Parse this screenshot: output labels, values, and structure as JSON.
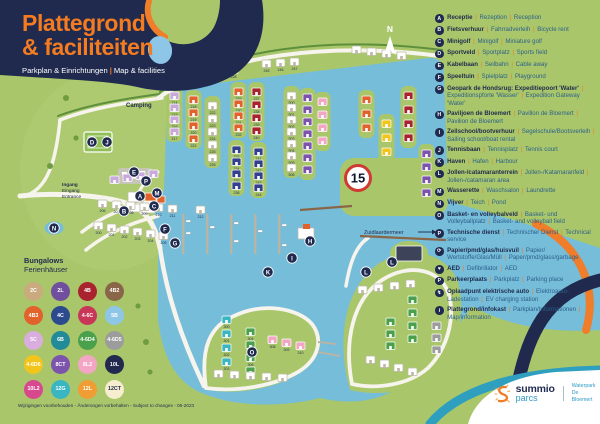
{
  "header": {
    "title_line1": "Plattegrond",
    "title_line2": "& faciliteiten",
    "subtitle_de": "Parkplan & Einrichtungen",
    "subtitle_en": "Map & facilities",
    "separator": "|"
  },
  "colors": {
    "brand_orange": "#f47b20",
    "brand_navy": "#1f2a4e",
    "water": "#76bdd9",
    "land_green": "#a9c76a",
    "sign_red": "#cf3a32"
  },
  "legend": {
    "separator": "|",
    "items": [
      {
        "badge": "A",
        "nl": "Receptie",
        "de": "Rezeption",
        "en": "Reception"
      },
      {
        "badge": "B",
        "nl": "Fietsverhuur",
        "de": "Fahrradverleih",
        "en": "Bicycle rent"
      },
      {
        "badge": "C",
        "nl": "Minigolf",
        "de": "Minigolf",
        "en": "Miniature golf"
      },
      {
        "badge": "D",
        "nl": "Sportveld",
        "de": "Sportplatz",
        "en": "Sports field"
      },
      {
        "badge": "E",
        "nl": "Kabelbaan",
        "de": "Seilbahn",
        "en": "Cable away"
      },
      {
        "badge": "F",
        "nl": "Speeltuin",
        "de": "Spielplatz",
        "en": "Playground"
      },
      {
        "badge": "G",
        "nl": "Geopark de Hondsrug: Expeditiepoort 'Water'",
        "de": "Expeditionspforte 'Wasser'",
        "en": "Expedition Gateway 'Water'"
      },
      {
        "badge": "H",
        "nl": "Paviljoen de Bloemert",
        "de": "Pavillon de Bloemert",
        "en": "Pavilion de Bloemert"
      },
      {
        "badge": "I",
        "nl": "Zeilschool/bootverhuur",
        "de": "Segelschule/Bootsverleih",
        "en": "Sailing school/boat rental"
      },
      {
        "badge": "J",
        "nl": "Tennisbaan",
        "de": "Tennisplatz",
        "en": "Tennis court"
      },
      {
        "badge": "K",
        "nl": "Haven",
        "de": "Hafen",
        "en": "Harbour"
      },
      {
        "badge": "L",
        "nl": "Jollen-/catamaranterrein",
        "de": "Jollen-/Katamaranfeld",
        "en": "Jollen-/catamaran area"
      },
      {
        "badge": "M",
        "nl": "Wasserette",
        "de": "Waschsalon",
        "en": "Laundrette"
      },
      {
        "badge": "N",
        "nl": "Vijver",
        "de": "Teich",
        "en": "Pond"
      },
      {
        "badge": "O",
        "nl": "Basket- en volleybalveld",
        "de": "Basket- und Volleyballplatz",
        "en": "Basket- and volleyball field"
      },
      {
        "badge": "P",
        "nl": "Technische dienst",
        "de": "Technischer Dienst",
        "en": "Technical service"
      },
      {
        "badge": "⟳",
        "icon": "recycle-icon",
        "nl": "Papier/pmd/glas/huisvuil",
        "de": "Papier/ Wertstoffe/Glas/Müll",
        "en": "Paper/pmd/glass/garbage"
      },
      {
        "badge": "♥",
        "icon": "aed-icon",
        "nl": "AED",
        "de": "Defibrillator",
        "en": "AED"
      },
      {
        "badge": "P",
        "icon": "parking-icon",
        "nl": "Parkeerplaats",
        "de": "Parkplatz",
        "en": "Parking place"
      },
      {
        "badge": "↯",
        "icon": "ev-charger-icon",
        "nl": "Oplaadpunt elektrische auto",
        "de": "Elektroauto-Ladestation",
        "en": "EV charging station"
      },
      {
        "badge": "i",
        "icon": "info-icon",
        "nl": "Plattegrond/infokast",
        "de": "Parkplan/Informationen",
        "en": "Map/information"
      }
    ]
  },
  "bungalows": {
    "title_nl": "Bungalows",
    "title_de": "Ferienhäuser",
    "types": [
      {
        "code": "2C",
        "color": "#c9ab7f"
      },
      {
        "code": "2L",
        "color": "#6f4f9e"
      },
      {
        "code": "4B",
        "color": "#a8232e"
      },
      {
        "code": "4B2",
        "color": "#8a6648"
      },
      {
        "code": "4B3",
        "color": "#e2622b"
      },
      {
        "code": "4C",
        "color": "#2c4a8e"
      },
      {
        "code": "4-6C",
        "color": "#c83757"
      },
      {
        "code": "5B",
        "color": "#8ec6e8"
      },
      {
        "code": "5C",
        "color": "#d9aede"
      },
      {
        "code": "6B",
        "color": "#238b97"
      },
      {
        "code": "4-6D4",
        "color": "#4ba04c"
      },
      {
        "code": "4-6D5",
        "color": "#9c9c9c"
      },
      {
        "code": "4-6D6",
        "color": "#f2c51d"
      },
      {
        "code": "8CT",
        "color": "#7c53ad"
      },
      {
        "code": "8L2",
        "color": "#f2a6c4"
      },
      {
        "code": "10L",
        "color": "#23294e"
      },
      {
        "code": "10L2",
        "color": "#d8488f"
      },
      {
        "code": "12G",
        "color": "#3ab6c3"
      },
      {
        "code": "12L",
        "color": "#f09d33"
      },
      {
        "code": "12CT",
        "color": "#f6eecf",
        "text": "#1f2a4e"
      }
    ]
  },
  "map": {
    "labels": {
      "camping": "Camping",
      "entrance_nl": "Ingang",
      "entrance_de": "Eingang",
      "entrance_en": "Entrance",
      "lake": "Zuidlaardermeer",
      "compass": "N",
      "speed_limit": "15"
    },
    "markers": [
      {
        "letter": "A",
        "x": 140,
        "y": 196
      },
      {
        "letter": "M",
        "x": 157,
        "y": 193
      },
      {
        "letter": "C",
        "x": 154,
        "y": 206
      },
      {
        "letter": "B",
        "x": 124,
        "y": 211
      },
      {
        "letter": "P",
        "x": 146,
        "y": 181
      },
      {
        "letter": "E",
        "x": 134,
        "y": 172
      },
      {
        "letter": "F",
        "x": 165,
        "y": 229
      },
      {
        "letter": "G",
        "x": 175,
        "y": 243
      },
      {
        "letter": "D",
        "x": 92,
        "y": 142
      },
      {
        "letter": "J",
        "x": 107,
        "y": 142
      },
      {
        "letter": "N",
        "x": 54,
        "y": 228
      },
      {
        "letter": "H",
        "x": 310,
        "y": 241
      },
      {
        "letter": "I",
        "x": 292,
        "y": 258
      },
      {
        "letter": "K",
        "x": 268,
        "y": 272
      },
      {
        "letter": "L",
        "x": 366,
        "y": 272
      },
      {
        "letter": "L",
        "x": 392,
        "y": 262
      },
      {
        "letter": "O",
        "x": 252,
        "y": 352
      }
    ],
    "house_clusters": [
      {
        "color": "#ffffff",
        "x": 94,
        "y": 222,
        "dx": 13,
        "dy": 2,
        "count": 6,
        "start": 200
      },
      {
        "color": "#ffffff",
        "x": 98,
        "y": 200,
        "dx": 14,
        "dy": 1,
        "count": 6,
        "start": 206
      },
      {
        "color": "#c9a8dc",
        "x": 110,
        "y": 176,
        "dx": 13,
        "dy": -2,
        "count": 4
      },
      {
        "color": "#ffffff",
        "x": 196,
        "y": 206,
        "count": 1,
        "start": 212
      },
      {
        "color": "#c9a8dc",
        "x": 170,
        "y": 92,
        "dy": 12,
        "count": 4,
        "start": 214,
        "finger": true
      },
      {
        "color": "#e2622b",
        "x": 189,
        "y": 96,
        "dy": 13,
        "count": 4,
        "start": 218,
        "finger": true
      },
      {
        "color": "#ffffff",
        "x": 208,
        "y": 102,
        "dy": 13,
        "count": 5,
        "start": 222,
        "finger": true
      },
      {
        "color": "#f2c51d",
        "x": 216,
        "y": 66,
        "dx": 13,
        "count": 2,
        "start": 227
      },
      {
        "color": "#e2622b",
        "x": 234,
        "y": 88,
        "dy": 12,
        "count": 4,
        "start": 229,
        "finger": true
      },
      {
        "color": "#33408f",
        "x": 232,
        "y": 146,
        "dy": 12,
        "count": 4,
        "start": 233,
        "finger": true
      },
      {
        "color": "#a8232e",
        "x": 252,
        "y": 88,
        "dy": 13,
        "count": 4,
        "start": 237,
        "finger": true
      },
      {
        "color": "#33408f",
        "x": 254,
        "y": 148,
        "dy": 12,
        "count": 4,
        "start": 241,
        "finger": true
      },
      {
        "color": "#ffffff",
        "x": 262,
        "y": 60,
        "dx": 14,
        "dy": -1,
        "count": 3,
        "start": 245
      },
      {
        "color": "#ffffff",
        "x": 287,
        "y": 92,
        "dy": 12,
        "count": 7,
        "start": 500,
        "finger": true
      },
      {
        "color": "#7c53ad",
        "x": 303,
        "y": 94,
        "dy": 12,
        "count": 7,
        "finger": true
      },
      {
        "color": "#f2a6c4",
        "x": 318,
        "y": 98,
        "dy": 13,
        "count": 4,
        "finger": true
      },
      {
        "color": "#ffffff",
        "x": 352,
        "y": 46,
        "dx": 15,
        "dy": 2,
        "count": 4
      },
      {
        "color": "#e2622b",
        "x": 362,
        "y": 96,
        "dy": 14,
        "count": 3,
        "finger": true
      },
      {
        "color": "#f2c51d",
        "x": 382,
        "y": 120,
        "dy": 14,
        "count": 3,
        "finger": true
      },
      {
        "color": "#a8232e",
        "x": 404,
        "y": 92,
        "dy": 14,
        "count": 4,
        "finger": true
      },
      {
        "color": "#7c53ad",
        "x": 422,
        "y": 150,
        "dy": 13,
        "count": 4,
        "finger": true
      },
      {
        "color": "#3ab6c3",
        "x": 222,
        "y": 316,
        "dy": 14,
        "count": 4,
        "start": 300
      },
      {
        "color": "#4ba04c",
        "x": 246,
        "y": 328,
        "dy": 13,
        "count": 4,
        "start": 304
      },
      {
        "color": "#f2a6c4",
        "x": 268,
        "y": 336,
        "dx": 14,
        "dy": 3,
        "count": 3,
        "start": 308
      },
      {
        "color": "#ffffff",
        "x": 214,
        "y": 370,
        "dx": 16,
        "dy": 1,
        "count": 5
      },
      {
        "color": "#ffffff",
        "x": 358,
        "y": 286,
        "dx": 16,
        "dy": -2,
        "count": 4
      },
      {
        "color": "#4ba04c",
        "x": 408,
        "y": 296,
        "dy": 13,
        "count": 4
      },
      {
        "color": "#9c9c9c",
        "x": 432,
        "y": 322,
        "dy": 12,
        "count": 3
      },
      {
        "color": "#ffffff",
        "x": 366,
        "y": 356,
        "dx": 14,
        "dy": 4,
        "count": 4
      },
      {
        "color": "#4ba04c",
        "x": 386,
        "y": 318,
        "dy": 12,
        "count": 3
      }
    ]
  },
  "footer": {
    "disclaimer": "Wijzigingen voorbehouden - Änderungen vorbehalten - Subject to changes - 06-2023"
  },
  "logo": {
    "brand": "summio",
    "brand2": "parcs",
    "park_line1": "Waterpark",
    "park_line2": "De Bloemert"
  }
}
